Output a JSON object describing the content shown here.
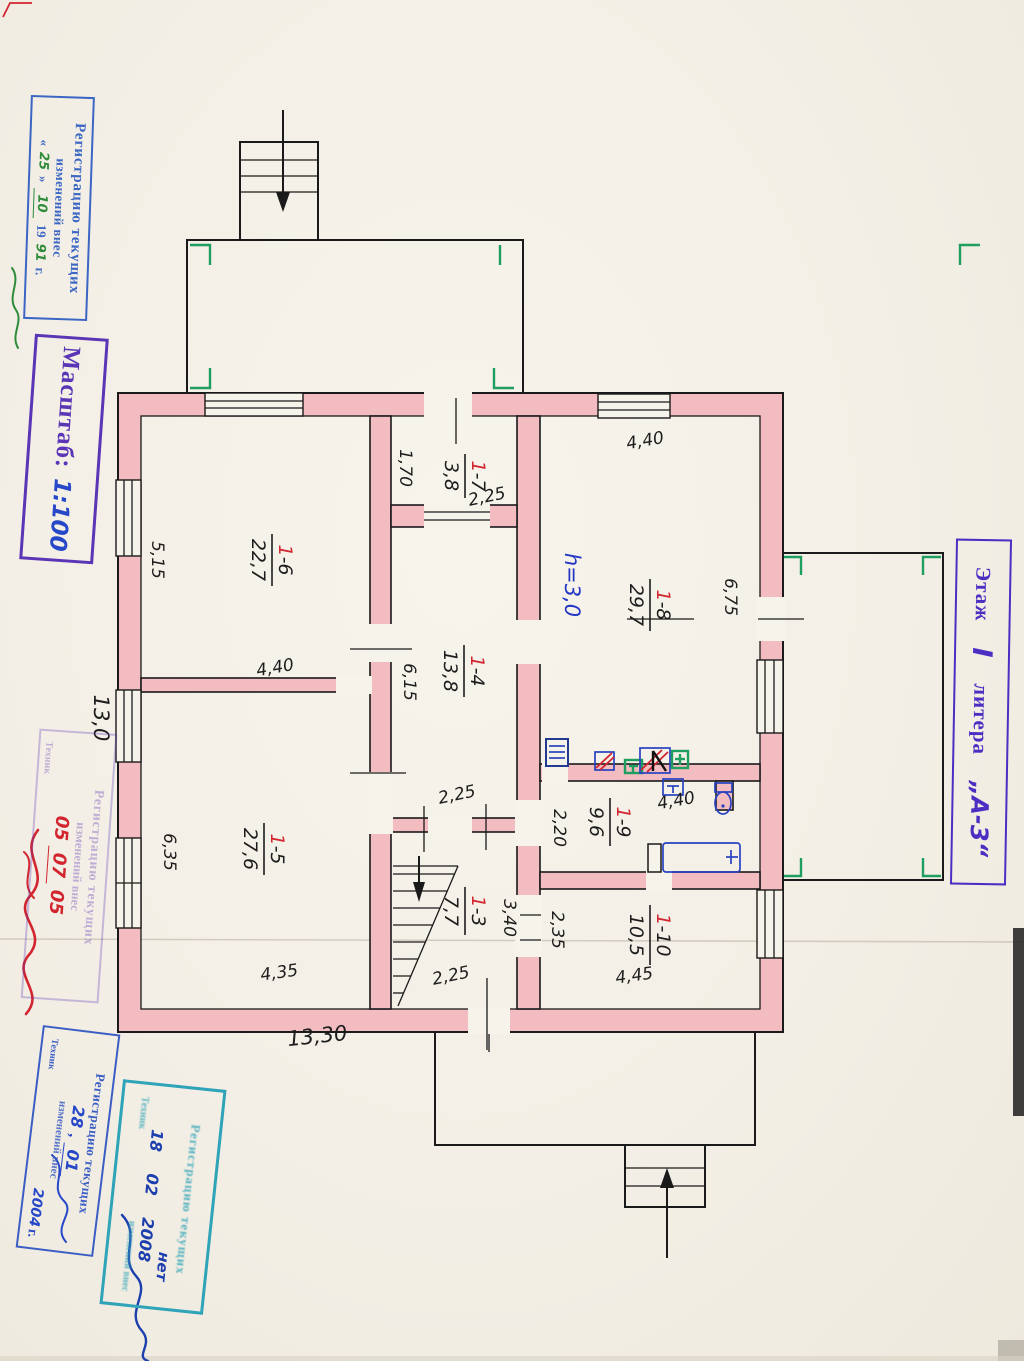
{
  "stamps": {
    "reg1991": {
      "l1": "Регистрацию текущих",
      "l2": "изменений внес",
      "q1": "«",
      "day": "25",
      "q2": "»",
      "month": "10",
      "year_pre": "19",
      "year": "91",
      "g": "г."
    },
    "scale": {
      "label": "Масштаб:",
      "value": "1:100"
    },
    "floor": {
      "word1": "Этаж",
      "num": "I",
      "word2": "литера",
      "lit": "„А-3“"
    },
    "reg2005": {
      "l1": "Регистрацию текущих",
      "l2": "изменений внес",
      "d1": "05",
      "d2": "07",
      "d3": "05",
      "role": "Техник"
    },
    "reg2004": {
      "l1": "Регистрацию текущих",
      "l2": "изменений внес",
      "day": "28",
      "comma": ",",
      "month": "01",
      "year": "2004",
      "g": "г.",
      "role": "Техник"
    },
    "reg2008": {
      "l1": "Регистрацию текущих",
      "l2": "изменений внес",
      "answer": "нет",
      "day": "18",
      "month": "02",
      "year": "2008",
      "role": "Техник"
    }
  },
  "plan": {
    "height_note": "h=3,0",
    "rooms": [
      {
        "n1": "1",
        "n2": "-6",
        "area": "22,7"
      },
      {
        "n1": "1",
        "n2": "-7",
        "area": "3,8"
      },
      {
        "n1": "1",
        "n2": "-8",
        "area": "29,7"
      },
      {
        "n1": "1",
        "n2": "-4",
        "area": "13,8"
      },
      {
        "n1": "1",
        "n2": "-5",
        "area": "27,6"
      },
      {
        "n1": "1",
        "n2": "-9",
        "area": "9,6"
      },
      {
        "n1": "1",
        "n2": "-3",
        "area": "7,7"
      },
      {
        "n1": "1",
        "n2": "-10",
        "area": "10,5"
      }
    ],
    "dims": [
      {
        "v": "4,40"
      },
      {
        "v": "6,75"
      },
      {
        "v": "5,15"
      },
      {
        "v": "1,70"
      },
      {
        "v": "2,25"
      },
      {
        "v": "4,40"
      },
      {
        "v": "6,15"
      },
      {
        "v": "13,0"
      },
      {
        "v": "6,35"
      },
      {
        "v": "2,25"
      },
      {
        "v": "2,20"
      },
      {
        "v": "4,40"
      },
      {
        "v": "3,40"
      },
      {
        "v": "2,35"
      },
      {
        "v": "4,45"
      },
      {
        "v": "4,35"
      },
      {
        "v": "2,25"
      },
      {
        "v": "13,30"
      }
    ]
  }
}
